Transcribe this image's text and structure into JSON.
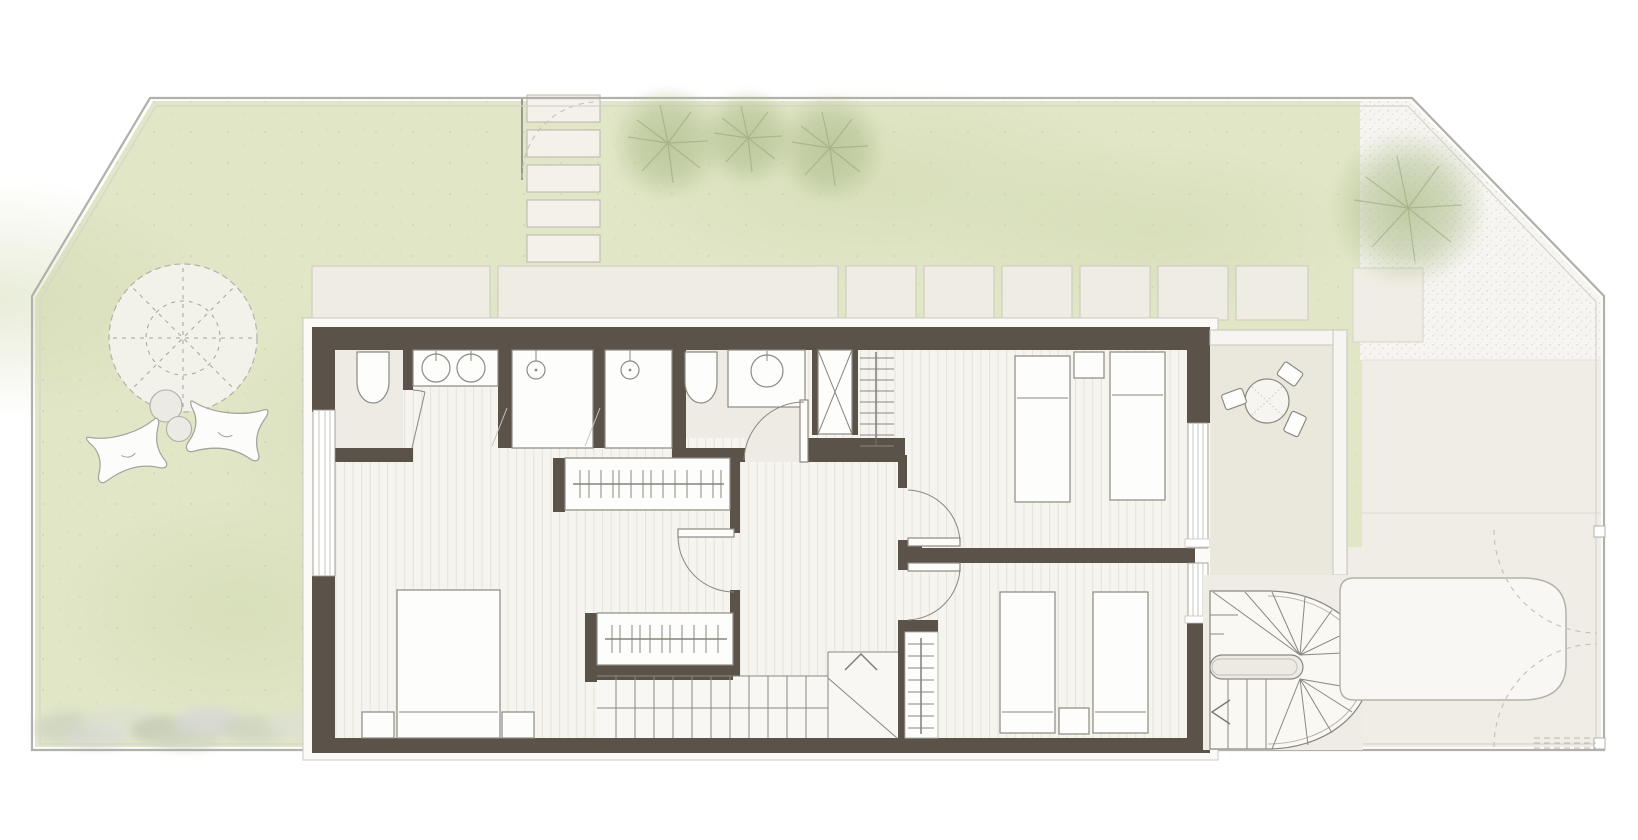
{
  "document": {
    "type": "architectural-floor-plan",
    "view": "top-down site plan with upper floor of a dwelling, garden, terrace and driveway"
  },
  "colors": {
    "page_bg": "#ffffff",
    "boundary": "#b2b0aa",
    "boundary_inner": "#d6d4cd",
    "lawn": "#e1e6c7",
    "lawn_shade": "#cdd6aa",
    "paver": "#efece3",
    "paver_edge": "#ccc9be",
    "gravel_base": "#f6f5f1",
    "gravel_dot": "#d8d6d0",
    "terrace_floor": "#eae7dd",
    "parapet": "#f6f5f1",
    "driveway": "#f0ede6",
    "wall": "#5b5349",
    "lip_fill": "#fbfaf7",
    "lip_stroke": "#ccc9c2",
    "plank_bg": "#f6f4ee",
    "plank_line": "#e6e3da",
    "bath_floor": "#edebe4",
    "stair_floor": "#f8f7f3",
    "fixture_fill": "#fdfdfb",
    "fixture_stroke": "#8d8a82",
    "line": "#8a8781",
    "light_line": "#c6c4bd",
    "tree": "#b3c192",
    "branch": "#93a276",
    "canopy_fill": "#f2f1ea",
    "canopy_stroke": "#b3b1a8",
    "shrub_green": "#cfd6c1",
    "shrub_gray": "#d8d8d4",
    "car_fill": "#f8f7f3",
    "car_stroke": "#b5b2a9"
  },
  "site": {
    "boundary_shape": "irregular hexagon with clipped upper-left and upper-right corners",
    "lawn": true,
    "gravel_garden": true,
    "shrub_border": true,
    "stepping_stones": 5,
    "paver_terrace_slabs": 8,
    "small_trees": 3,
    "large_trees": 1,
    "round_garden_canopy": 1,
    "floor_cushions": 2,
    "garden_stones": 2,
    "gate_posts": 2,
    "parked_car": 1
  },
  "house": {
    "rooms": [
      {
        "name": "master-bedroom",
        "furniture": [
          "double-bed",
          "nightstand",
          "nightstand",
          "wardrobe-rail",
          "wardrobe-rail"
        ]
      },
      {
        "name": "master-bath-zone",
        "fixtures": [
          "toilet",
          "double-sink-vanity",
          "shower-stall",
          "shower-stall"
        ]
      },
      {
        "name": "bathroom-2",
        "fixtures": [
          "toilet",
          "sink-vanity"
        ]
      },
      {
        "name": "bedroom-2",
        "furniture": [
          "single-bed",
          "single-bed",
          "nightstand",
          "towel-radiator"
        ]
      },
      {
        "name": "bedroom-3",
        "furniture": [
          "single-bed",
          "single-bed",
          "nightstand",
          "towel-radiator"
        ]
      },
      {
        "name": "hallway",
        "features": [
          "straight-staircase",
          "landing-direction-arrow"
        ]
      }
    ],
    "service_shaft": 1,
    "interior_doors": 5,
    "windows": 3,
    "exterior_spiral_staircase": 1
  },
  "terrace": {
    "round_table": 1,
    "chairs": 3
  }
}
